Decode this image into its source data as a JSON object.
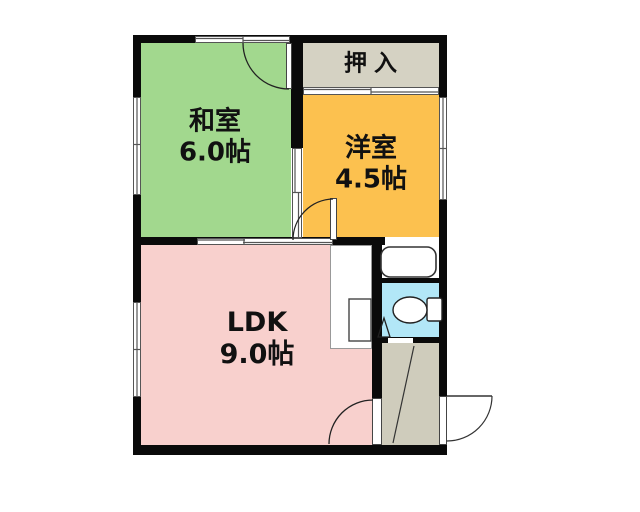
{
  "plan": {
    "type": "apartment-floor-plan",
    "rooms": {
      "oshiire": {
        "label": "押入"
      },
      "washitsu": {
        "label": "和室",
        "size": "6.0帖"
      },
      "youshitsu": {
        "label": "洋室",
        "size": "4.5帖"
      },
      "ldk": {
        "label": "LDK",
        "size": "9.0帖"
      }
    },
    "colors": {
      "washitsu": "#a2d88e",
      "youshitsu": "#fcc14f",
      "ldk": "#f8d0cd",
      "oshiire": "#d5d2c3",
      "entrance": "#cfccbc",
      "toilet_room": "#b2e7f7",
      "bath_room": "#ffffff",
      "wall": "#0a0a0a"
    },
    "fixtures": {
      "bathtub": "bathtub-icon",
      "toilet": "toilet-icon",
      "kitchen_sink": "kitchen-sink-icon",
      "entrance_step": "genkan-step-line",
      "doors": [
        "washitsu-top-door",
        "youshitsu-door",
        "ldk-entrance-door",
        "entrance-exterior-door",
        "toilet-door"
      ]
    }
  }
}
